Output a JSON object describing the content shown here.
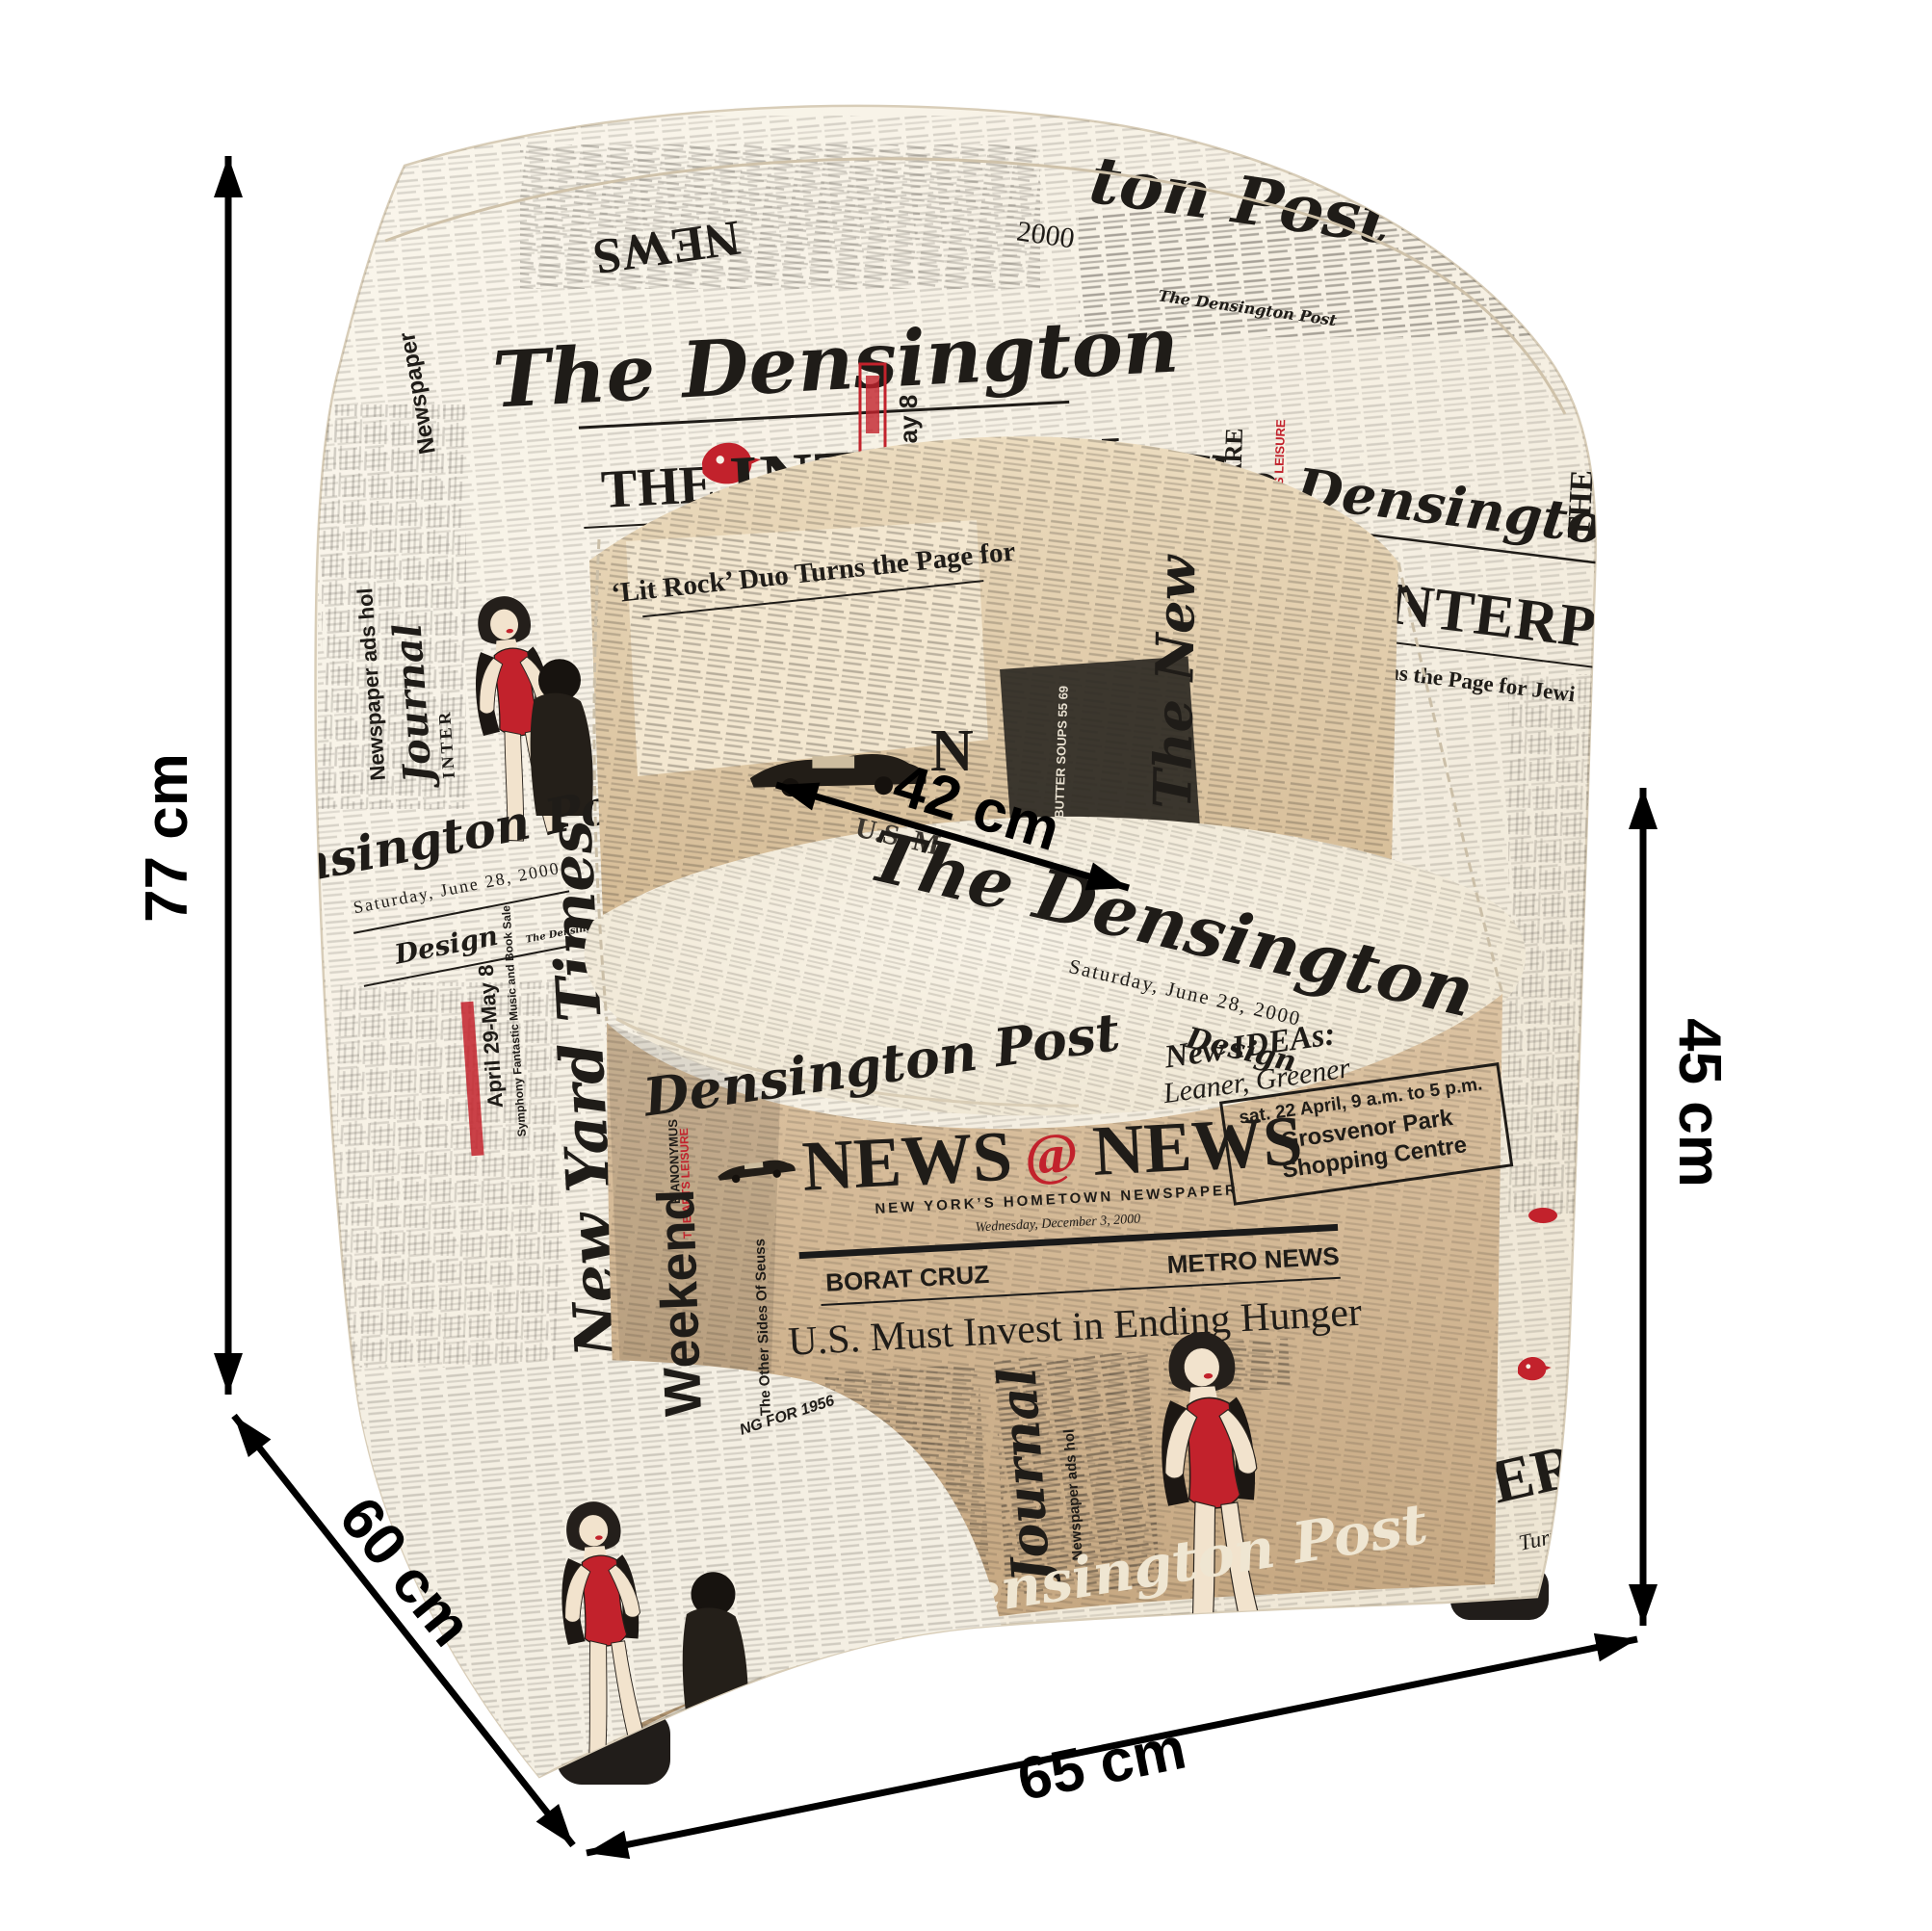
{
  "dimensions": {
    "height": {
      "label": "77 cm"
    },
    "depth": {
      "label": "60 cm"
    },
    "width": {
      "label": "65 cm"
    },
    "seat_height": {
      "label": "45 cm"
    },
    "seat_depth": {
      "label": "42 cm"
    }
  },
  "fabric": {
    "densington": "The Densington",
    "densington_post": "Densington Post",
    "densington_post_full": "The Densington Post",
    "the": "THE",
    "interpen": "INTERPEN",
    "nterpend": "NTERPEND",
    "ton_post": "ton Post",
    "year_2000": "2000",
    "lit_rock": "‘Lit Rock’ Duo Turns the Page for",
    "lit_rock_right": "Rock’ Duo Turns the Page for Jewi",
    "saturday_june": "Saturday, June 28, 2000",
    "design": "Design",
    "us_fragment": "U.S. M",
    "new_yard_times": "The New Yard Times",
    "ny_friday": "NEW YORK, FRIDAY, MAY 28, 2000",
    "the_new": "The New",
    "weekend": "Weekend",
    "other_sides": "The Other Sides Of Seuss",
    "family_fare": "FAMILY FARE",
    "eanonymus": "E.ANONYMUS",
    "arts_leisure": "THE ARTS LEISURE",
    "newspaper": "Newspaper",
    "newspaper_ads": "Newspaper ads hol",
    "journal": "Journal",
    "inter": "INTER",
    "april_dates": "April 29-May 8",
    "symphony": "Symphony Fantastic Music and Book Sale",
    "news": "NEWS",
    "at_sign": "@",
    "news_tagline": "NEW YORK’S HOMETOWN NEWSPAPER",
    "news_date": "Wednesday, December 3, 2000",
    "borat": "BORAT CRUZ",
    "metro": "METRO NEWS",
    "hunger": "U.S. Must Invest in Ending Hunger",
    "new_ideas": "New IDEAs:",
    "leaner": "Leaner, Greener",
    "sat_april": "sat. 22 April, 9 a.m. to 5 p.m.",
    "grosvenor_1": "Grosvenor Park",
    "grosvenor_2": "Shopping Centre",
    "butter": "BUTTER SOUPS 55 69",
    "for_1956": "NG FOR 1956",
    "eri": "ERI",
    "turns_th": "Turns th",
    "letter_n": "N",
    "letter_y": "Y"
  },
  "colors": {
    "background": "#ffffff",
    "dimension_ink": "#000000",
    "fabric_cream": "#f6f1e6",
    "fabric_tan": "#d9bf9d",
    "newsprint_ink": "#1f1c18",
    "accent_red": "#c2222c",
    "foot_black": "#211d1a"
  }
}
